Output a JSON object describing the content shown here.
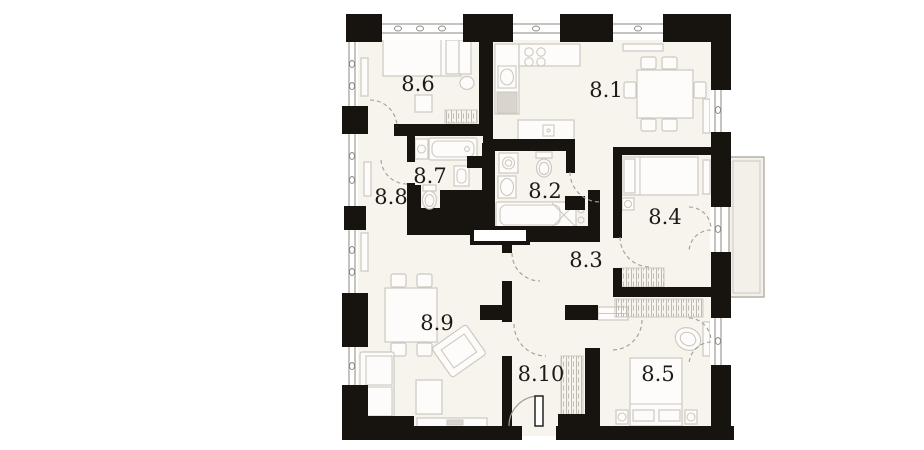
{
  "plan": {
    "name": "apartment-floor-plan",
    "rooms": [
      {
        "id": "room-8-6",
        "label": "8.6"
      },
      {
        "id": "room-8-1",
        "label": "8.1"
      },
      {
        "id": "room-8-7",
        "label": "8.7"
      },
      {
        "id": "room-8-8",
        "label": "8.8"
      },
      {
        "id": "room-8-2",
        "label": "8.2"
      },
      {
        "id": "room-8-4",
        "label": "8.4"
      },
      {
        "id": "room-8-3",
        "label": "8.3"
      },
      {
        "id": "room-8-9",
        "label": "8.9"
      },
      {
        "id": "room-8-10",
        "label": "8.10"
      },
      {
        "id": "room-8-5",
        "label": "8.5"
      }
    ]
  },
  "colors": {
    "wall": "#17140f",
    "floor": "#f7f3ed",
    "balcony": "#f3efe9",
    "furniture_stroke": "#cdc9c1",
    "furniture_fill": "#fdfcfa",
    "appliance_fill": "#d9d5cd",
    "door_arc": "#a29e96",
    "window_line": "#8d8981",
    "label": "#1c1a17",
    "background": "#ffffff"
  }
}
